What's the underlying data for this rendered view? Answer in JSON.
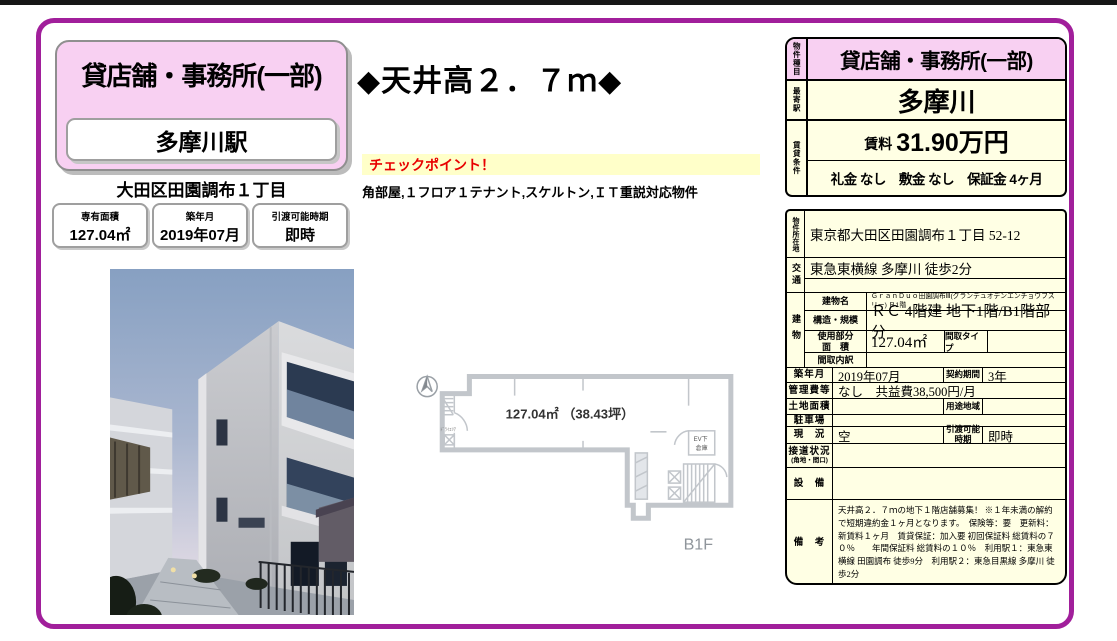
{
  "colors": {
    "frame_purple": "#a11f9b",
    "badge_pink": "#f8d0f2",
    "table_cream": "#ffffe4",
    "checkpoint_yellow": "#ffffc9",
    "checkpoint_red": "#e80000"
  },
  "header_left": {
    "property_type": "貸店舗・事務所(一部)",
    "station": "多摩川駅",
    "address": "大田区田園調布１丁目",
    "info_boxes": [
      {
        "label": "専有面積",
        "value": "127.04㎡"
      },
      {
        "label": "築年月",
        "value": "2019年07月"
      },
      {
        "label": "引渡可能時期",
        "value": "即時"
      }
    ]
  },
  "center": {
    "headline": "◆天井高２．７ｍ◆",
    "checkpoint_title": "チェックポイント！",
    "checkpoint_body": "角部屋,１フロア１テナント,スケルトン,ＩＴ重説対応物件",
    "floorplan": {
      "area_label": "127.04㎡ （38.43坪）",
      "floor_label": "B1F",
      "ev_label": "EV下",
      "storage_label": "倉庫",
      "dry_area_label": "ﾄﾞﾗｲｴﾘｱ"
    }
  },
  "summary_table": {
    "property_type_label": "物件種目",
    "property_type": "貸店舗・事務所(一部)",
    "station_label": "最寄駅",
    "station": "多摩川",
    "terms_label": "賃貸条件",
    "rent_label": "賃料",
    "rent_value": "31.90万円",
    "terms": "礼金 なし　敷金 なし　保証金 4ヶ月"
  },
  "detail_table": {
    "location_label": "物件所在地",
    "location": "東京都大田区田園調布１丁目 52-12",
    "access_label": "交通",
    "access": "東急東横線 多摩川 徒歩2分",
    "building_label": "建物",
    "building_name_label": "建物名",
    "building_name": "ＧｒａｎＤｕｏ田園調布Ⅲ(グランデュオデンエンチョウフスリー) Ｂ1階",
    "structure_label": "構造・規模",
    "structure": "ＲＣ 4階建 地下1階/B1階部分",
    "used_area_label1": "使用部分",
    "used_area_label2": "面　積",
    "used_area": "127.04㎡",
    "madori_type_label": "間取タイプ",
    "madori_type": "",
    "madori_detail_label": "間取内訳",
    "madori_detail": "",
    "rows": [
      {
        "label": "築年月",
        "value": "2019年07月",
        "label2": "契約期間",
        "value2": "3年"
      },
      {
        "label": "管理費等",
        "value": "なし　共益費38,500円/月"
      },
      {
        "label": "土地面積",
        "value": "",
        "label2": "用途地域",
        "value2": ""
      },
      {
        "label": "駐車場",
        "value": ""
      },
      {
        "label": "現　況",
        "value": "空",
        "label2": "引渡可能時期",
        "value2": "即時"
      },
      {
        "label": "接道状況",
        "sublabel": "(角地・間口)",
        "value": ""
      },
      {
        "label": "設　備",
        "value": ""
      },
      {
        "label": "備　考",
        "value": "天井高２．７ｍの地下１階店舗募集！ ※１年未満の解約で短期違約金１ヶ月となります。　保険等：要　更新料：新賃料１ヶ月　賃貸保証：加入要 初回保証料 総賃料の７０％　　年間保証料 総賃料の１０％　利用駅１：東急東横線 田園調布 徒歩9分　利用駅２：東急目黒線 多摩川 徒歩2分"
      }
    ]
  }
}
